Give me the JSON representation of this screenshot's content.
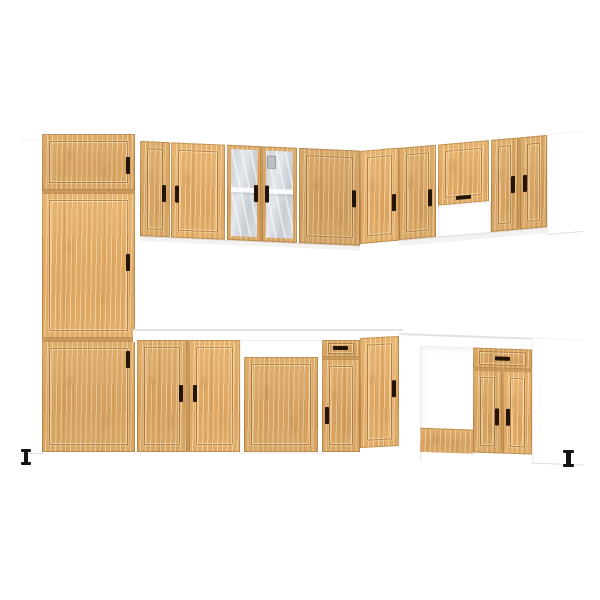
{
  "image": {
    "description": "3D product render of an L-shaped kitchen cabinet set with light artisan-oak doors and white carcass on a plain white background",
    "background_color": "#ffffff"
  },
  "colors": {
    "bg": "#ffffff",
    "wood": "#d9a763",
    "wood_gap": "#c79a5b",
    "plinth_wood": "#dcab69",
    "carcass": "#ffffff",
    "handle": "#231407",
    "shelf": "#fbfcfd",
    "counter_edge": "#dfe3e6",
    "foot": "#141414"
  },
  "scene": {
    "style": "shaker-style recessed door panels, dark vertical bar handles",
    "wall_units": [
      "tall cabinet with three doors (left end, white side panel)",
      "narrow single-door wall cabinet",
      "wide single-door wall cabinet",
      "two-door glass display wall cabinet with middle shelf and visible hinge",
      "single-door wall cabinet",
      "angled corner wall door",
      "single-door wall cabinet on right run",
      "extractor-hood wall cabinet with flap door over open recess",
      "two-door wall cabinet on right run",
      "white wall end panel"
    ],
    "base_units": [
      "two-door base cabinet under white worktop",
      "appliance base cabinet with low door and white carcass gap",
      "drawer-over-door base cabinet",
      "angled corner base door",
      "open appliance bay with wooden plinth strip",
      "drawer-over-two-door base cabinet on right run",
      "white base end panel"
    ],
    "counts": {
      "handles": 21,
      "feet": 2,
      "glass_doors": 2,
      "shelves_visible": 1
    },
    "worktop": "white",
    "floor": "white, no visible shadow"
  }
}
